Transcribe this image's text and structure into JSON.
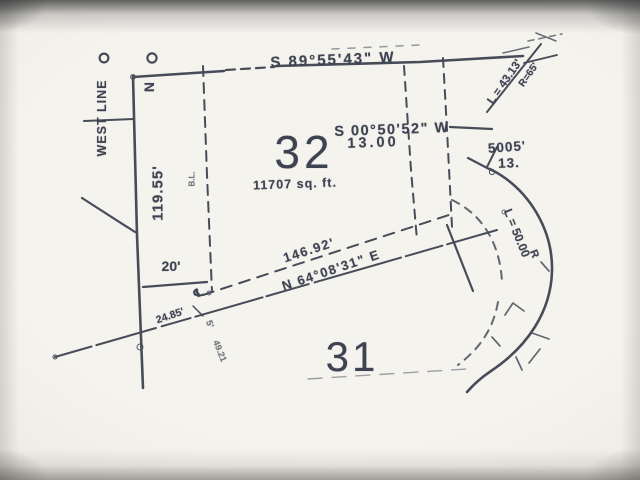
{
  "labels": {
    "north": "N",
    "west_line": "WEST LINE",
    "top_bearing": "S 89°55'43\" W",
    "east_bearing": "S 00°50'52\" W",
    "east_distance": "13.00",
    "lot32_number": "32",
    "lot32_area": "11707 sq. ft.",
    "west_distance": "119.55'",
    "building_line": "B.L.",
    "offset": "20'",
    "road_distance": "146.92'",
    "road_bearing": "N 64°08'31\" E",
    "centerline_distance": "24.85'",
    "centerline_symbol": "℄",
    "easement_width": "5'",
    "small_distance": "49.21",
    "curve_top_length": "L = 43.13'",
    "curve_top_radius": "R=65'",
    "curve_right_length": "L = 50.00",
    "curve_right_radius": "R",
    "right_distance": "5005'",
    "right_secondary": "13.",
    "lot31_number": "31"
  },
  "colors": {
    "ink": "#474c59",
    "paper": "#f1efe9"
  }
}
